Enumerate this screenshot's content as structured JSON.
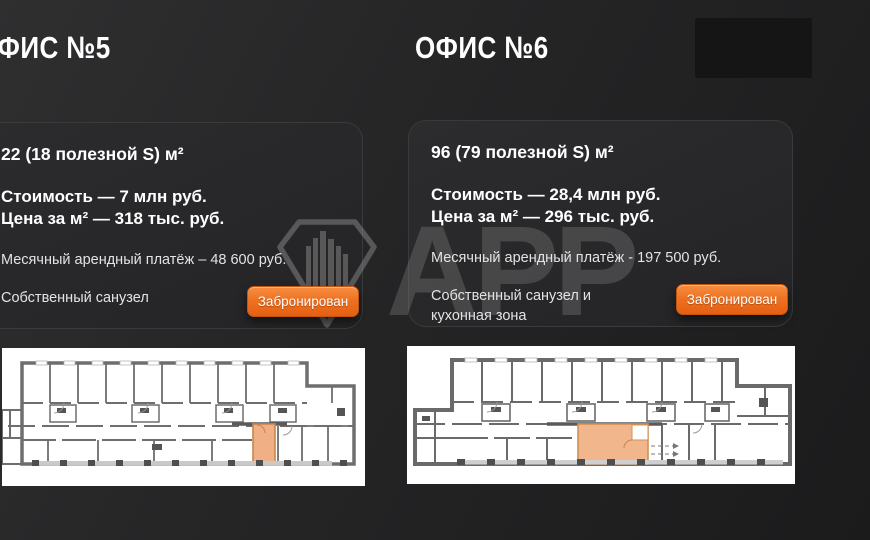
{
  "watermark": {
    "text": "АРР",
    "logo": "diamond-building-logo"
  },
  "colors": {
    "page_bg": "#232324",
    "card_bg": "#29292B",
    "accent_orange": "#EE7223",
    "plan_highlight_office5": "#F1AF85",
    "plan_highlight_office6": "#F2B68C",
    "watermark_gray": "#8F8F8F"
  },
  "listings": [
    {
      "title": "ОФИС №5",
      "area": "22 (18 полезной S) м²",
      "cost": "Стоимость — 7 млн руб.",
      "price_per_m2": "Цена за м² — 318 тыс. руб.",
      "rent": "Месячный арендный платёж – 48 600 руб.",
      "features": "Собственный санузел",
      "button_label": "Забронирован",
      "status": "Забронирован"
    },
    {
      "title": "ОФИС №6",
      "area": "96 (79 полезной S) м²",
      "cost": "Стоимость — 28,4 млн руб.",
      "price_per_m2": "Цена за м² — 296 тыс. руб.",
      "rent": "Месячный арендный платёж - 197 500 руб.",
      "features": "Собственный санузел и кухонная зона",
      "button_label": "Забронирован",
      "status": "Забронирован"
    }
  ]
}
